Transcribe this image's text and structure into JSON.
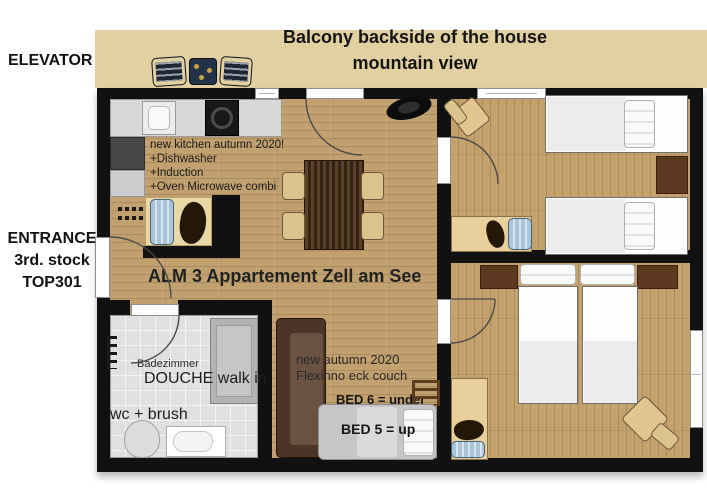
{
  "colors": {
    "wall": "#111111",
    "wood_floor": "#c1a170",
    "balcony": "#e3d0a2",
    "bathroom_tile": "#e0e0e0",
    "couch_brown": "#4a3526",
    "nightstand_brown": "#5d3a1f"
  },
  "labels": {
    "elevator": "ELEVATOR",
    "entrance": [
      "ENTRANCE",
      "3rd. stock",
      "TOP301"
    ],
    "balcony_line1": "Balcony backside of the house",
    "balcony_line2": "mountain view"
  },
  "living": {
    "title": "ALM 3 Appartement Zell am See",
    "kitchen_note": [
      "new kitchen autumn 2020!",
      "+Dishwasher",
      "+Induction",
      "+Oven Microwave combi"
    ],
    "couch_note": [
      "new autumn 2020",
      "Flexinno eck couch"
    ],
    "bed6_label": "BED 6 = under",
    "bed5_label": "BED 5 = up"
  },
  "bathroom": {
    "room_label": "Badezimmer",
    "shower_label": "DOUCHE walk in",
    "wc_label": "wc + brush"
  }
}
